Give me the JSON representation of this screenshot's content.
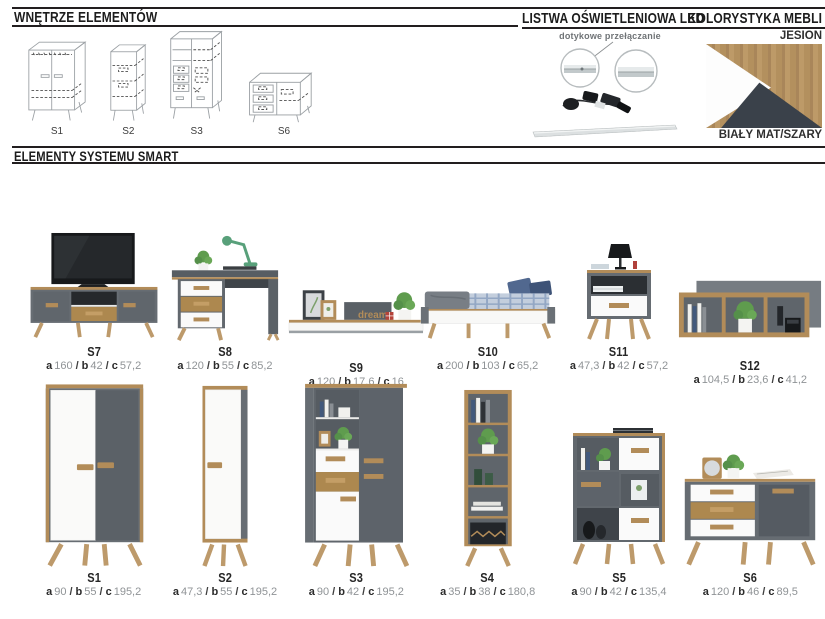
{
  "header": {
    "interiors_title": "WNĘTRZE ELEMENTÓW",
    "led_title": "LISTWA OŚWIETLENIOWA LED",
    "colors_title": "KOLORYSTYKA MEBLI"
  },
  "interiors": {
    "items": [
      {
        "code": "S1"
      },
      {
        "code": "S2"
      },
      {
        "code": "S3"
      },
      {
        "code": "S6"
      }
    ]
  },
  "led": {
    "caption": "dotykowe przełączanie"
  },
  "colors": {
    "top_label": "JESION",
    "bottom_label": "BIAŁY MAT/SZARY",
    "wood_hex": "#b3905e",
    "white_hex": "#fdfdfd",
    "dark_hex": "#3a414a"
  },
  "elements": {
    "title": "ELEMENTY SYSTEMU SMART",
    "dim_labels": {
      "a": "a",
      "b": "b",
      "c": "c",
      "sep": "/"
    },
    "row1": [
      {
        "code": "S7",
        "a": "160",
        "b": "42",
        "c": "57,2"
      },
      {
        "code": "S8",
        "a": "120",
        "b": "55",
        "c": "85,2"
      },
      {
        "code": "S9",
        "a": "120",
        "b": "17,6",
        "c": "16"
      },
      {
        "code": "S10",
        "a": "200",
        "b": "103",
        "c": "65,2"
      },
      {
        "code": "S11",
        "a": "47,3",
        "b": "42",
        "c": "57,2"
      },
      {
        "code": "S12",
        "a": "104,5",
        "b": "23,6",
        "c": "41,2"
      }
    ],
    "row2": [
      {
        "code": "S1",
        "a": "90",
        "b": "55",
        "c": "195,2"
      },
      {
        "code": "S2",
        "a": "47,3",
        "b": "55",
        "c": "195,2"
      },
      {
        "code": "S3",
        "a": "90",
        "b": "42",
        "c": "195,2"
      },
      {
        "code": "S4",
        "a": "35",
        "b": "38",
        "c": "180,8"
      },
      {
        "code": "S5",
        "a": "90",
        "b": "42",
        "c": "135,4"
      },
      {
        "code": "S6",
        "a": "120",
        "b": "46",
        "c": "89,5"
      }
    ]
  },
  "decor": {
    "dream": "dream"
  }
}
